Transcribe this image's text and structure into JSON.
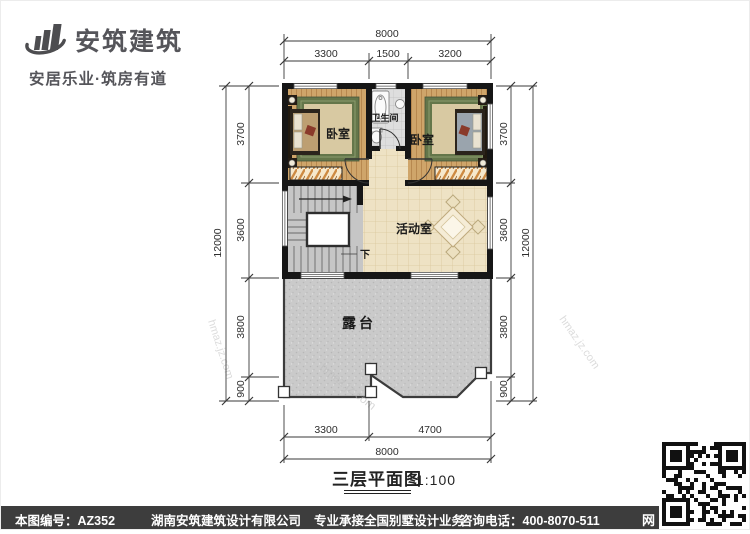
{
  "header": {
    "brand": "安筑建筑",
    "tagline": "安居乐业·筑房有道"
  },
  "plan": {
    "labels": {
      "bedroom_left": "卧室",
      "bedroom_right": "卧室",
      "bathroom": "卫生间",
      "activity_room": "活动室",
      "terrace": "露台",
      "stair_down": "下"
    },
    "title": "三层平面图",
    "scale": "1:100",
    "dims": {
      "top": {
        "total": "8000",
        "segments": [
          "3300",
          "1500",
          "3200"
        ]
      },
      "bottom": {
        "total": "8000",
        "segments": [
          "3300",
          "4700"
        ]
      },
      "left": {
        "total": "12000",
        "segments": [
          "3700",
          "3600",
          "3800",
          "900"
        ]
      },
      "right": {
        "total": "12000",
        "segments": [
          "3700",
          "3600",
          "3800",
          "900"
        ]
      }
    }
  },
  "watermark": {
    "text": "hmaz.jz.com"
  },
  "footer": {
    "drawing_no": "本图编号：AZ352",
    "company": "湖南安筑建筑设计有限公司",
    "service": "专业承接全国别墅设计业务",
    "phone": "咨询电话：400-8070-511",
    "web_label": "网"
  },
  "colors": {
    "wall": "#161616",
    "wood_floor": "#cfa56a",
    "carpet_green": "#64764a",
    "tile_cream": "#eee2c4",
    "terrace_gray": "#cacaca",
    "footer_bar": "#3d3d3d",
    "brand_gray": "#55555a"
  }
}
